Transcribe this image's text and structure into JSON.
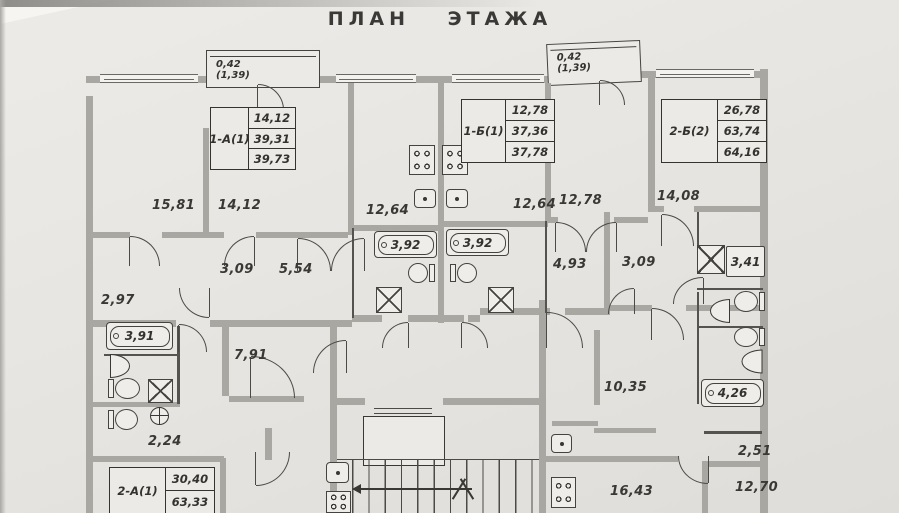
{
  "title": "ПЛАН ЭТАЖА",
  "colors": {
    "paper": "#e8e6e2",
    "wall": "#a9a7a2",
    "line": "#4c4a46",
    "text": "#34322f"
  },
  "balconies": [
    {
      "area": "0,42",
      "area_total": "(1,39)"
    },
    {
      "area": "0,42",
      "area_total": "(1,39)"
    }
  ],
  "apartments": [
    {
      "name": "1-А(1)",
      "values": [
        "14,12",
        "39,31",
        "39,73"
      ]
    },
    {
      "name": "1-Б(1)",
      "values": [
        "12,78",
        "37,36",
        "37,78"
      ]
    },
    {
      "name": "2-Б(2)",
      "values": [
        "26,78",
        "63,74",
        "64,16"
      ]
    },
    {
      "name": "2-А(1)",
      "values": [
        "30,40",
        "63,33"
      ]
    }
  ],
  "rooms": [
    {
      "label": "15,81"
    },
    {
      "label": "14,12"
    },
    {
      "label": "12,64"
    },
    {
      "label": "12,64"
    },
    {
      "label": "12,78"
    },
    {
      "label": "14,08"
    },
    {
      "label": "3,09"
    },
    {
      "label": "5,54"
    },
    {
      "label": "3,92"
    },
    {
      "label": "3,92"
    },
    {
      "label": "4,93"
    },
    {
      "label": "3,09"
    },
    {
      "label": "3,41"
    },
    {
      "label": "2,97"
    },
    {
      "label": "3,91"
    },
    {
      "label": "7,91"
    },
    {
      "label": "10,35"
    },
    {
      "label": "4,26"
    },
    {
      "label": "2,24"
    },
    {
      "label": "2,51"
    },
    {
      "label": "12,70"
    },
    {
      "label": "16,43"
    }
  ],
  "fixtures": [
    "bathtub",
    "toilet",
    "sink",
    "shower-cabin",
    "washing-machine",
    "stove",
    "kitchen-sink",
    "elevator",
    "stairs"
  ]
}
